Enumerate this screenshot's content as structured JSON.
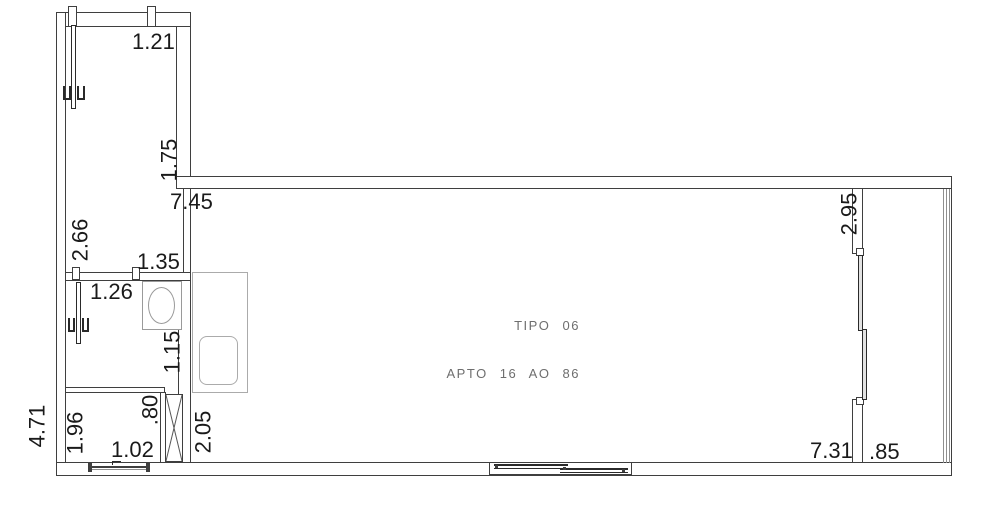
{
  "drawing": {
    "title_line1": "TIPO 06",
    "title_line2": "APTO 16 AO 86"
  },
  "dimensions": {
    "d121": "1.21",
    "d175": "1.75",
    "d745": "7.45",
    "d266": "2.66",
    "d135": "1.35",
    "d126": "1.26",
    "d115": "1.15",
    "d080": ".80",
    "d196": "1.96",
    "d102": "1.02",
    "d205": "2.05",
    "d471": "4.71",
    "d295": "2.95",
    "d731": "7.31",
    "d085": ".85"
  },
  "colors": {
    "wall": "#3f3f3f",
    "fixture": "#ababab",
    "dimtext": "#1a1a1a",
    "labeltext": "#6e6e6e",
    "door": "#2a2a2a",
    "bg": "#ffffff"
  }
}
